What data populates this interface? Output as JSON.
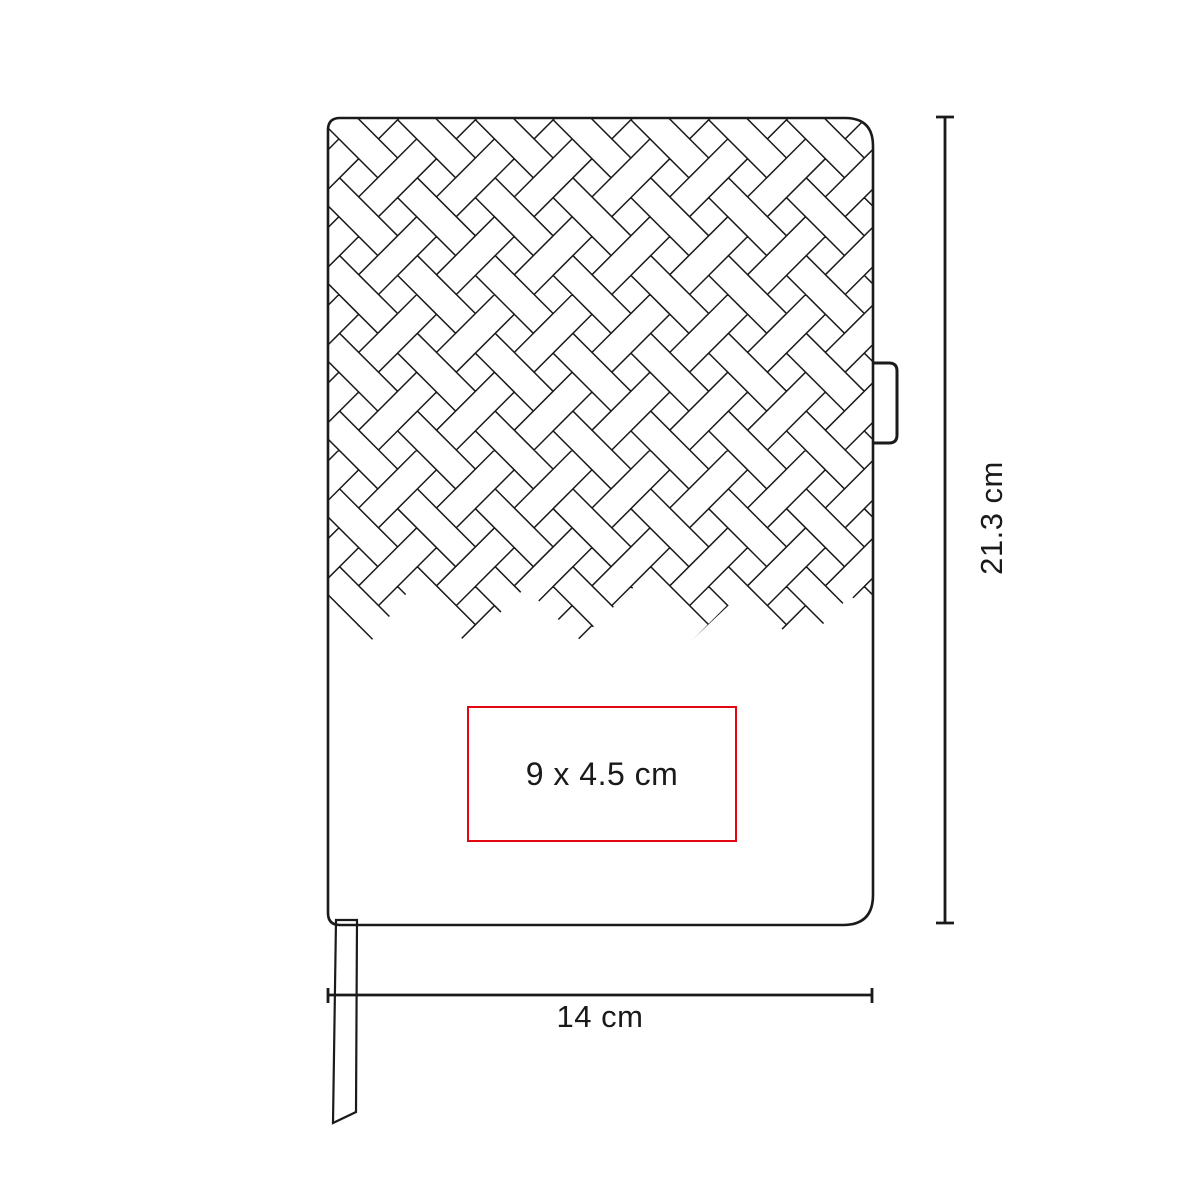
{
  "diagram": {
    "print_area_label": "9 x 4.5 cm",
    "height_label": "21.3 cm",
    "width_label": "14 cm"
  },
  "colors": {
    "ink": "#1a1a1a",
    "accent_red": "#e30613"
  }
}
